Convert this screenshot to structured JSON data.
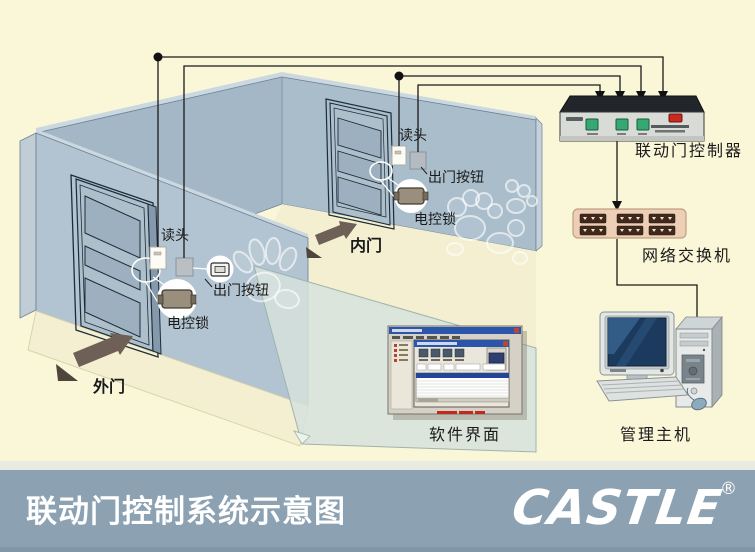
{
  "banner": {
    "title": "联动门控制系统示意图",
    "brand": "CASTLE",
    "registered_mark": "®"
  },
  "room": {
    "outer_door": {
      "door_label": "外门",
      "reader_label": "读头",
      "exit_button_label": "出门按钮",
      "lock_label": "电控锁"
    },
    "inner_door": {
      "door_label": "内门",
      "reader_label": "读头",
      "exit_button_label": "出门按钮",
      "lock_label": "电控锁"
    }
  },
  "equipment": {
    "controller_label": "联动门控制器",
    "network_switch_label": "网络交换机",
    "software_label": "软件界面",
    "management_host_label": "管理主机"
  },
  "colors": {
    "background": "#faf7d9",
    "wall": "#a6bac8",
    "wall_light": "#b2c4d1",
    "glass_wall": "#d5e2dc",
    "floor": "#f3efd0",
    "banner": "#8ca2b2",
    "wire": "#1a1a1a",
    "controller_button": "#36a873",
    "controller_power": "#c9291f",
    "switch_body": "#eccfb6",
    "direction_arrow": "#6e6057"
  }
}
